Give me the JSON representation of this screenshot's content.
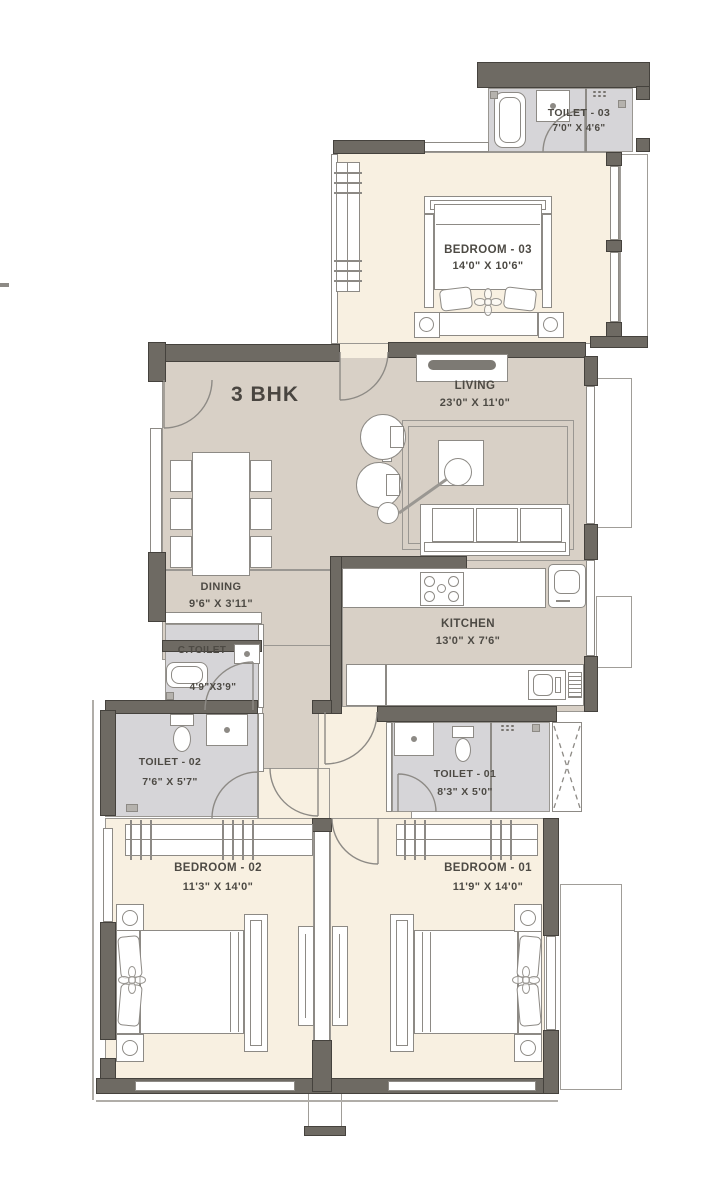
{
  "title": "3 BHK",
  "rooms": {
    "toilet3": {
      "name": "TOILET - 03",
      "dims": "7'0\" X 4'6\""
    },
    "bedroom3": {
      "name": "BEDROOM - 03",
      "dims": "14'0\" X 10'6\""
    },
    "living": {
      "name": "LIVING",
      "dims": "23'0\" X 11'0\""
    },
    "dining": {
      "name": "DINING",
      "dims": "9'6\" X 3'11\""
    },
    "kitchen": {
      "name": "KITCHEN",
      "dims": "13'0\" X 7'6\""
    },
    "ctoilet": {
      "name": "C.TOILET",
      "dims": "4'9\"X3'9\""
    },
    "toilet2": {
      "name": "TOILET - 02",
      "dims": "7'6\" X 5'7\""
    },
    "toilet1": {
      "name": "TOILET - 01",
      "dims": "8'3\" X 5'0\""
    },
    "bedroom2": {
      "name": "BEDROOM - 02",
      "dims": "11'3\" X 14'0\""
    },
    "bedroom1": {
      "name": "BEDROOM - 01",
      "dims": "11'9\" X 14'0\""
    }
  },
  "colors": {
    "wall": "#6e6a63",
    "floor_bedroom": "#f8f0e1",
    "floor_living": "#d8d0c6",
    "floor_toilet": "#d6d5d8",
    "outline": "#8d8a85",
    "text": "#4d4a44"
  }
}
